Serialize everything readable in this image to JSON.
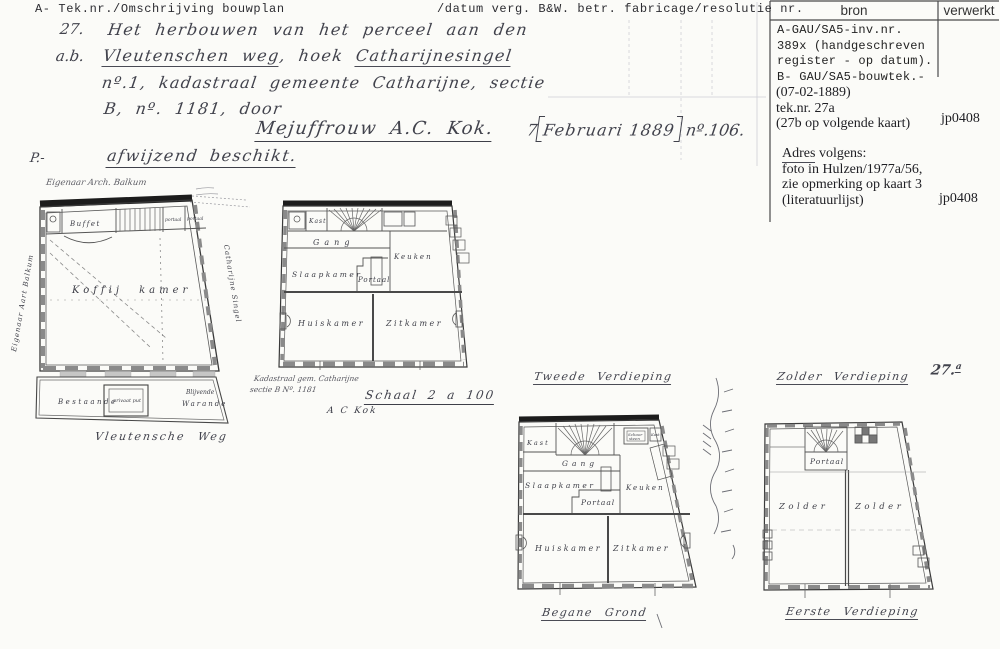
{
  "header": {
    "left": "A- Tek.nr./Omschrijving bouwplan",
    "center": "/datum verg. B&W. betr. fabricage/resolutie nr."
  },
  "bron_table": {
    "col_bron": "bron",
    "col_verwerkt": "verwerkt",
    "entry_a_lines": [
      "A-GAU/SA5-inv.nr.",
      "389x (handgeschreven",
      "register - op datum).",
      "B- GAU/SA5-bouwtek.-"
    ],
    "entry_b_lines": [
      "(07-02-1889)",
      "tek.nr. 27a",
      "(27b op volgende kaart)"
    ],
    "entry_b_verwerkt": "jp0408",
    "adres_word": "Adres",
    "adres_suffix": " volgens:",
    "adres_lines": [
      "foto in Hulzen/1977a/56,",
      "zie opmerking op kaart 3",
      "(literatuurlijst)"
    ],
    "adres_verwerkt": "jp0408"
  },
  "handwriting": {
    "margin_mark": "P.-",
    "item_no": "27.",
    "line1": "Het herbouwen van het perceel aan den",
    "line2_prefix": "a.b.",
    "line2_underlined1": "Vleutenschen weg",
    "line2_middle": ", hoek ",
    "line2_underlined2": "Catharijnesingel",
    "line3": "nº.1, kadastraal gemeente Catharijne, sectie",
    "line4": "B, nº. 1181, door",
    "applicant": "Mejuffrouw A.C. Kok.",
    "date_day": "7",
    "date_bracketed": "Februari 1889",
    "resolution_no": "nº.106.",
    "verdict": "afwijzend beschikt."
  },
  "plans": {
    "sheet_number": "27.",
    "sheet_number_sup": "a",
    "ground": {
      "owner_note": "Eigenaar Arch. Balkum",
      "owner_side_note": "Eigenaar Aart Balkum",
      "street": "Vleutensche Weg",
      "singel": "Catharijne Singel",
      "rooms": {
        "buffet": "Buffet",
        "portaal1": "portaal",
        "portaal2": "portaal",
        "koffijkamer": "Koffij kamer",
        "bestaande": "Bestaande",
        "privaat_put": "privaat put",
        "blijvende": "Blijvende",
        "warande": "Warande"
      }
    },
    "first": {
      "caption_line1": "Kadastraal gem. Catharijne",
      "caption_line2": "sectie B Nº. 1181",
      "scale": "Schaal 2 a 100",
      "signature": "A C Kok",
      "rooms": {
        "kast": "Kast",
        "gang": "Gang",
        "slaapkamer": "Slaapkamer",
        "portaal": "Portaal",
        "keuken": "Keuken",
        "huiskamer": "Huiskamer",
        "zitkamer": "Zitkamer"
      }
    },
    "second": {
      "title": "Tweede Verdieping",
      "bottom_label": "Begane Grond",
      "rooms": {
        "kast": "Kast",
        "schoorsteen1": "Schoor",
        "schoorsteen2": "steen",
        "kast2": "Kast",
        "gang": "Gang",
        "slaapkamer": "Slaapkamer",
        "portaal": "Portaal",
        "keuken": "Keuken",
        "huiskamer": "Huiskamer",
        "zitkamer": "Zitkamer"
      }
    },
    "attic": {
      "title": "Zolder Verdieping",
      "bottom_label": "Eerste Verdieping",
      "rooms": {
        "portaal": "Portaal",
        "zolder1": "Zolder",
        "zolder2": "Zolder"
      }
    }
  }
}
